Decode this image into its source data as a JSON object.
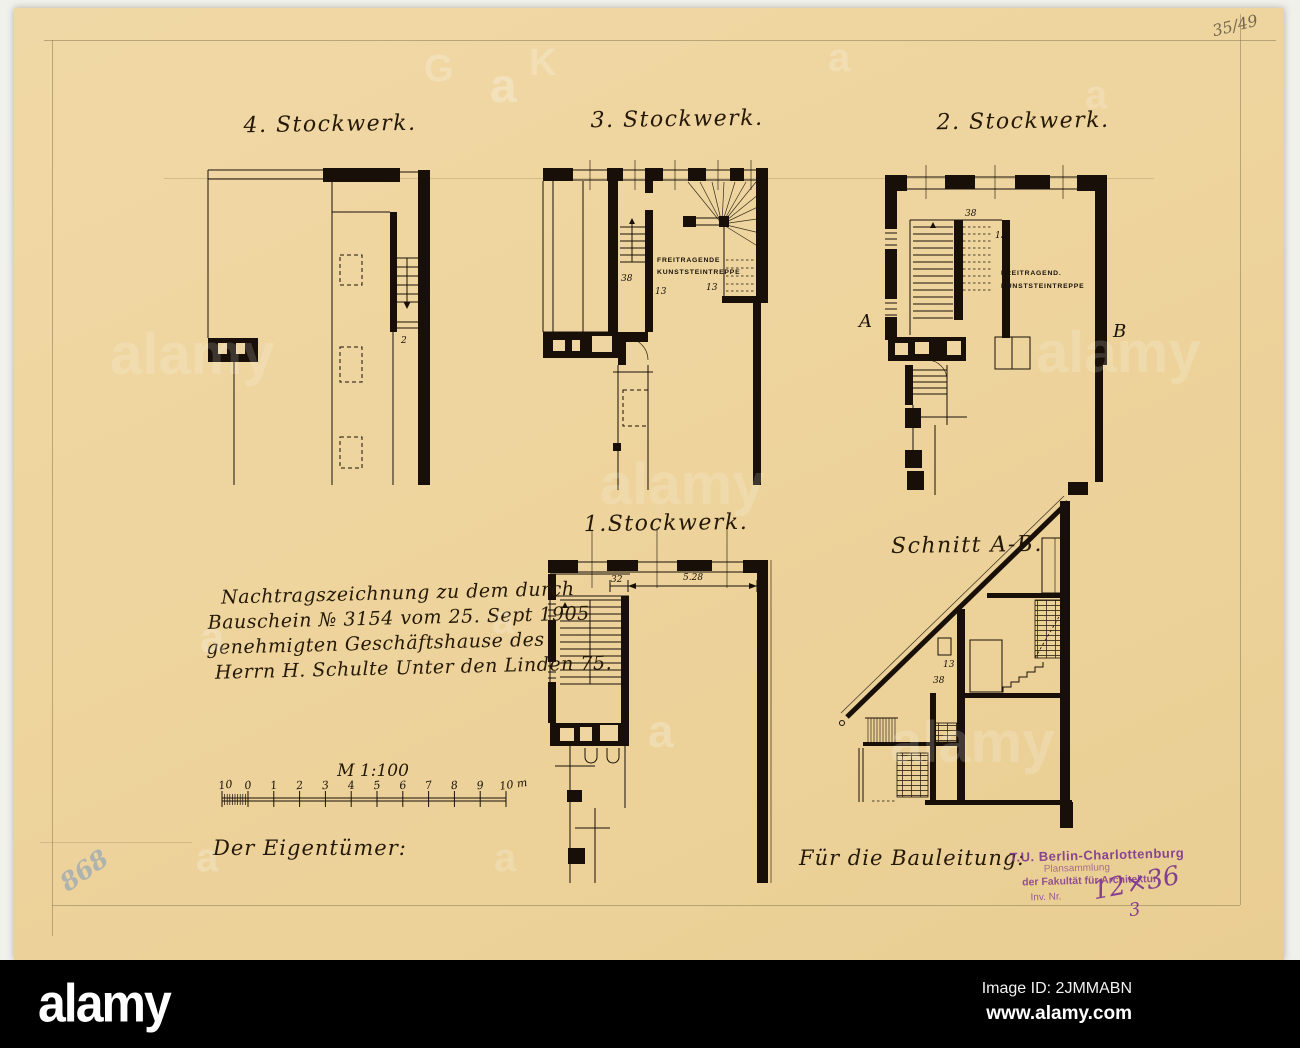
{
  "colors": {
    "paper": "#eed49d",
    "paper2": "#eed5a1",
    "ink": "#181008",
    "pencil": "#8d7b54",
    "stamp": "#7c3190",
    "blue_note": "#7e9ac0",
    "footer_bg": "#000000",
    "footer_text": "#ffffff"
  },
  "notes": {
    "corner": "35/49",
    "blue": "868"
  },
  "plans": {
    "floor4": {
      "title": "4. Stockwerk.",
      "dim1": "2"
    },
    "floor3": {
      "title": "3. Stockwerk.",
      "note1": "FREITRAGENDE",
      "note2": "KUNSTSTEINTREPPE",
      "dim1": "38",
      "dim2": "13",
      "dim3": "13"
    },
    "floor2": {
      "title": "2. Stockwerk.",
      "note1": "FREITRAGEND.",
      "note2": "KUNSTSTEINTREPPE",
      "dim1": "38",
      "dim2": "13",
      "marker_a": "A",
      "marker_b": "B"
    },
    "floor1": {
      "title": "1.Stockwerk.",
      "dim1": "32",
      "dim2": "5.28"
    },
    "section": {
      "title": "Schnitt A-B.",
      "dim1": "13",
      "dim2": "38"
    }
  },
  "annotation": {
    "line1": "Nachtragszeichnung zu dem durch",
    "line2": "Bauschein № 3154 vom 25. Sept 1905",
    "line3": "genehmigten Geschäftshause des",
    "line4": "Herrn H. Schulte Unter den Linden 75."
  },
  "scale": {
    "label": "M 1:100",
    "ticks": [
      "10",
      "0",
      "1",
      "2",
      "3",
      "4",
      "5",
      "6",
      "7",
      "8",
      "9",
      "10 m"
    ]
  },
  "sign_offs": {
    "owner": "Der Eigentümer:",
    "construction": "Für die Bauleitung:"
  },
  "stamp": {
    "line1": "T.U. Berlin-Charlottenburg",
    "line2": "Plansammlung",
    "line3": "der Fakultät für Architektur",
    "line4": "Inv. Nr.",
    "inv_number": "12×36",
    "inv_sub": "3"
  },
  "watermark": {
    "letter": "a",
    "word": "alamy",
    "ghost_g": "G",
    "ghost_k": "K"
  },
  "footer": {
    "logo": "alamy",
    "image_id": "Image ID: 2JMMABN",
    "website": "www.alamy.com"
  }
}
